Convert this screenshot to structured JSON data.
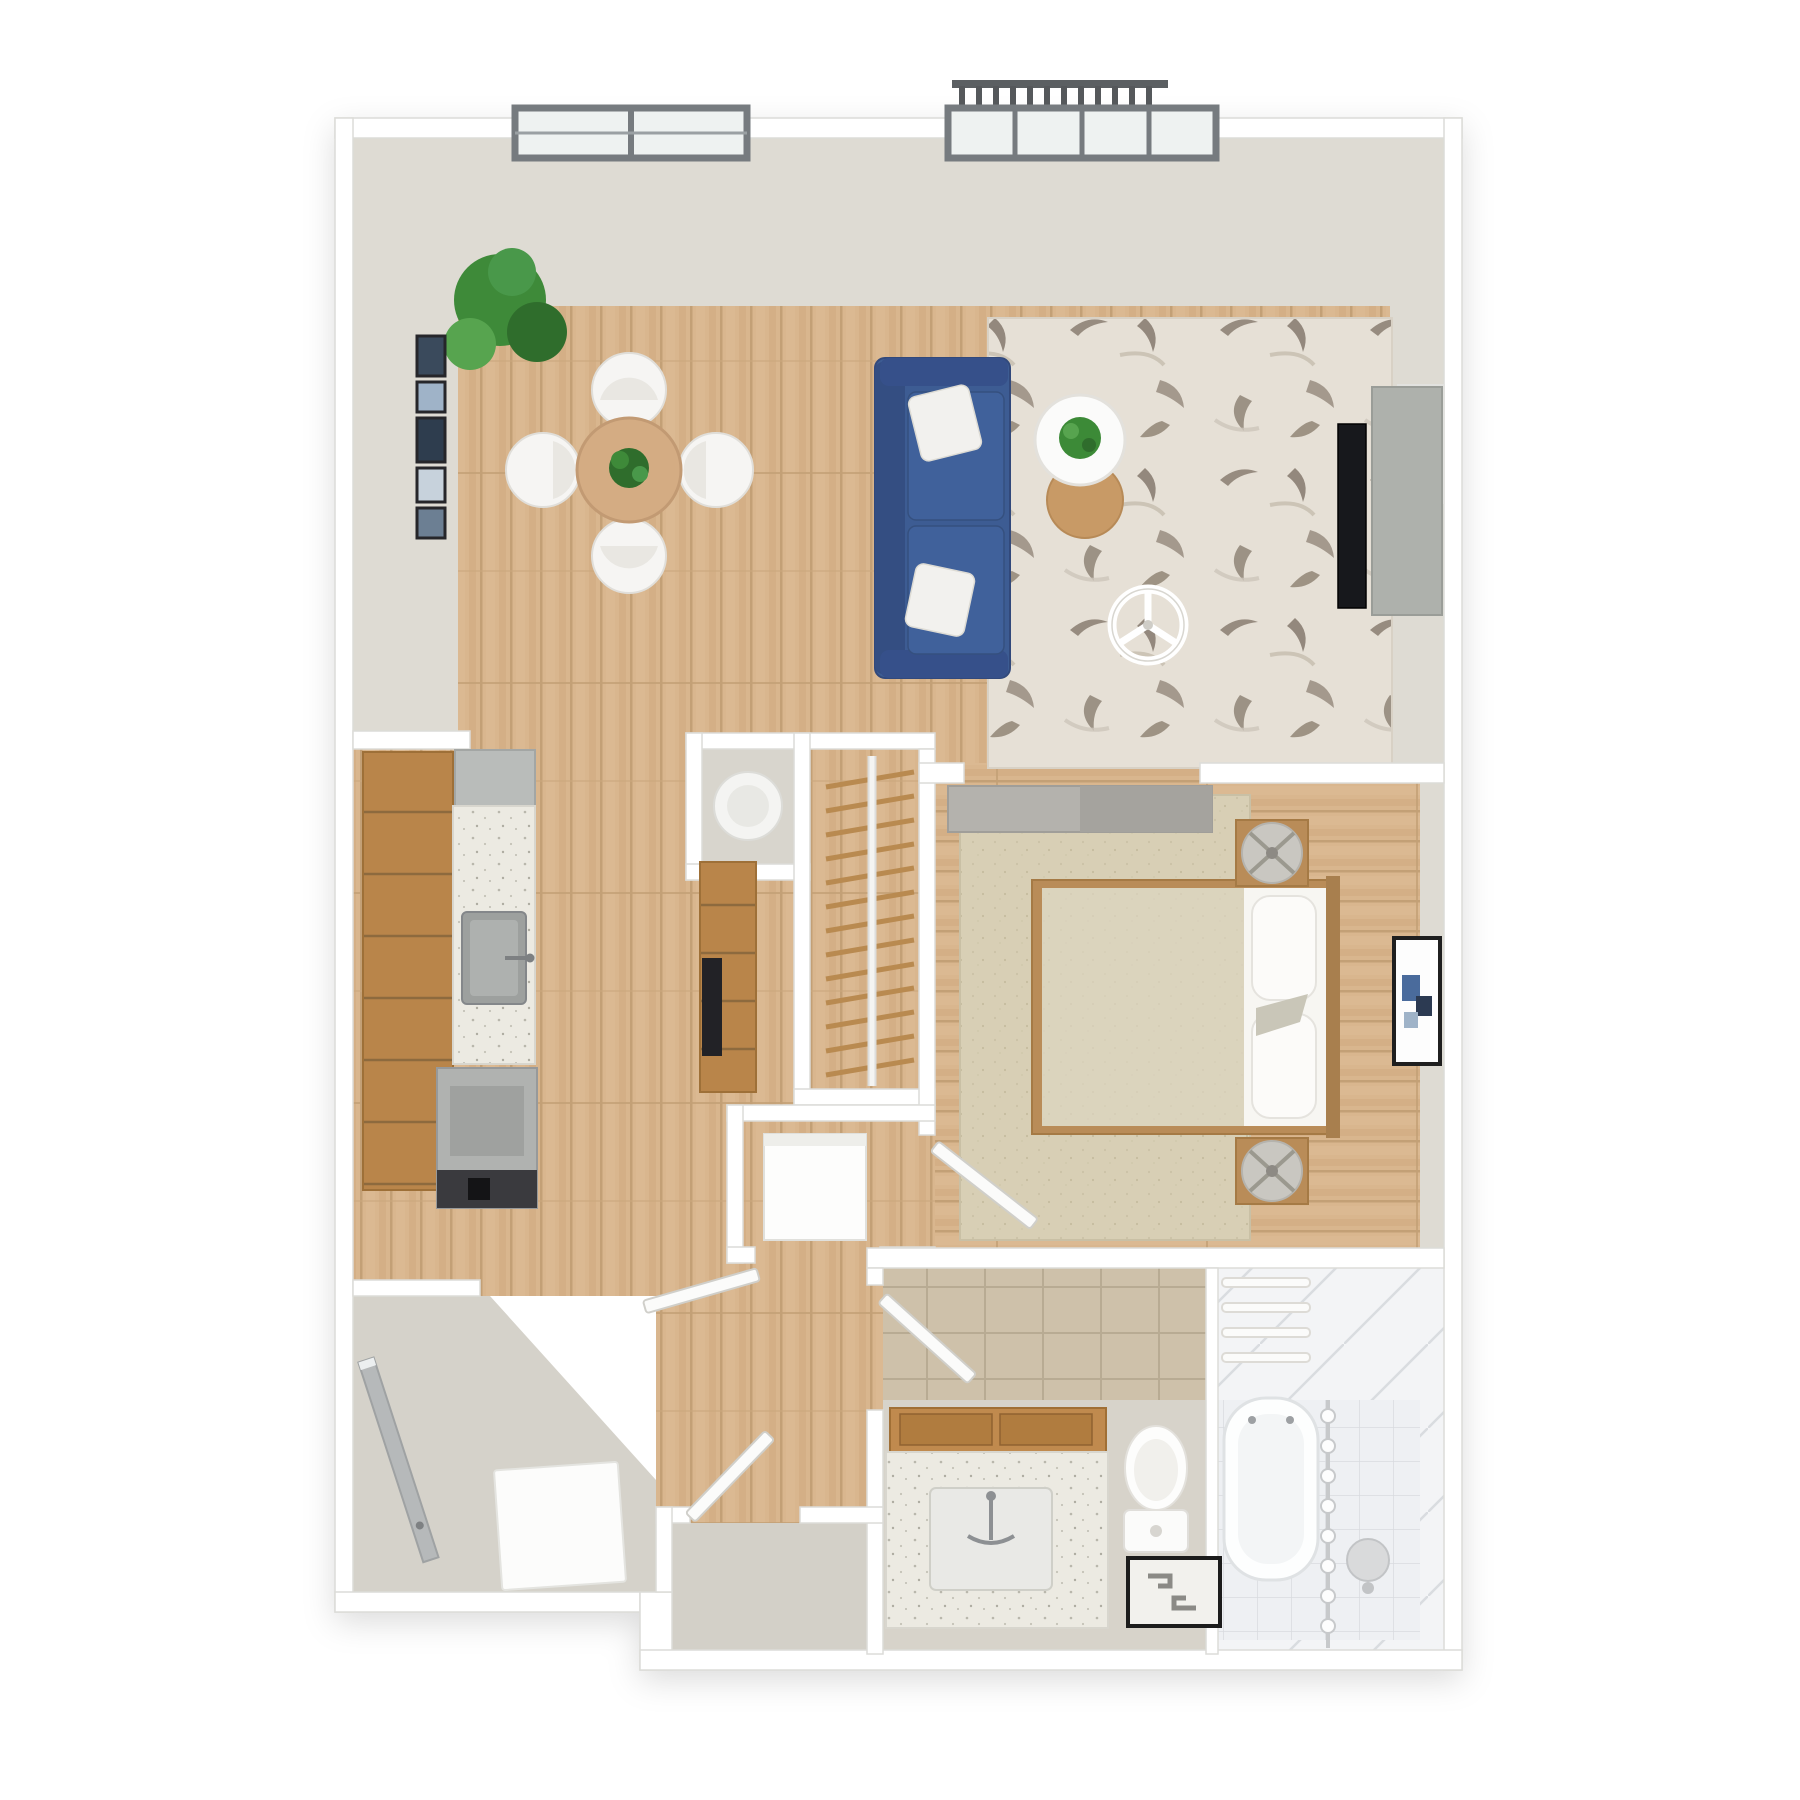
{
  "meta": {
    "artwork": "3D top-down floor plan rendering",
    "unit_type": "one-bedroom apartment",
    "visible_text": "none"
  },
  "palette": {
    "background": "#ffffff",
    "wall_white": "#ffffff",
    "wall_edge": "#dcdcd8",
    "wall_face_greige": "#dedbd3",
    "wood_floor": "#d9b68e",
    "wood_plank_dark": "#c3a076",
    "entry_floor_gray": "#d5d2ca",
    "rug_living_base": "#e6e0d6",
    "rug_living_motif": "#8a7e71",
    "rug_bedroom": "#d8cfb5",
    "sofa_blue": "#3d5c93",
    "cabinet_wood": "#b9854a",
    "counter_speckle": "#eceae2",
    "appliance_gray": "#b0b2b0",
    "oven_black": "#313136",
    "tv_black": "#17181c",
    "console_gray": "#aeb1ac",
    "tile_tan": "#cec1aa",
    "tile_white": "#f3f4f6",
    "window_frame": "#767b7f",
    "window_glass": "#eef2f1",
    "plant_green": "#3e8a39",
    "lamp_gray": "#c9c7c1",
    "front_door_gray": "#b6b9ba"
  },
  "rooms": {
    "living": {
      "label": "Living room",
      "furniture": [
        "blue sofa with two white pillows",
        "patterned area rug",
        "round white coffee table with plant",
        "round wood side table",
        "wall-mounted TV",
        "media console",
        "decorative fan ornament"
      ]
    },
    "dining": {
      "label": "Dining area",
      "furniture": [
        "round dining table",
        "four white tub chairs",
        "table centerpiece plant",
        "potted floor plant",
        "gallery wall frames"
      ]
    },
    "kitchen": {
      "label": "Kitchen",
      "furniture": [
        "wood cabinet run",
        "speckled countertop",
        "sink with faucet",
        "refrigerator",
        "range with oven"
      ]
    },
    "bedroom": {
      "label": "Bedroom",
      "furniture": [
        "double bed with beige duvet",
        "two pillows",
        "accent pillow",
        "two wood nightstands",
        "two round table lamps",
        "area rug",
        "framed wall art",
        "sliding barn door"
      ]
    },
    "bathroom": {
      "label": "Bathroom",
      "furniture": [
        "vanity with basket shelf",
        "inset sink with faucet",
        "toilet",
        "patterned floor mat",
        "bathtub with shower curtain rod",
        "towel bars",
        "shower stool"
      ]
    },
    "entry": {
      "label": "Entry",
      "furniture": [
        "front door",
        "door mat"
      ]
    },
    "hallway": {
      "label": "Hallway",
      "furniture": [
        "open interior doors"
      ]
    },
    "closet": {
      "label": "Walk-in closet",
      "furniture": [
        "clothes rod",
        "wood hangers",
        "tall wood pantry cabinet",
        "built-in oven column",
        "washer niche with round appliance"
      ]
    },
    "storage": {
      "label": "Storage alcove",
      "furniture": [
        "white utility cabinet"
      ]
    },
    "balcony": {
      "label": "Balcony",
      "furniture": [
        "sliding glass door",
        "railing with slats"
      ]
    }
  },
  "windows": {
    "dining_window_panes": 2,
    "balcony_door_panes": 4
  },
  "generated": {
    "closet_hangers": {
      "count": 13,
      "x1": 826,
      "x2": 914,
      "y_start": 772,
      "step": 24,
      "rise": 15
    },
    "railing_slats": {
      "count": 12,
      "x_start": 962,
      "step": 17,
      "y1": 86,
      "y2": 110
    },
    "curtain_rings": {
      "count": 8,
      "x": 1328,
      "y_start": 1416,
      "step": 30,
      "r": 7
    },
    "towel_bars": {
      "count": 4,
      "x": 1222,
      "w": 88,
      "h": 9,
      "y_start": 1278,
      "step": 25
    },
    "wall_frames": {
      "x": 417,
      "w": 28,
      "items": [
        {
          "y": 336,
          "h": 40,
          "color": "#3a4a5c"
        },
        {
          "y": 382,
          "h": 30,
          "color": "#9fb3c8"
        },
        {
          "y": 418,
          "h": 44,
          "color": "#2e3d4e"
        },
        {
          "y": 468,
          "h": 34,
          "color": "#c7d2dc"
        },
        {
          "y": 508,
          "h": 30,
          "color": "#6c7f93"
        }
      ]
    },
    "cabinet_seams": {
      "count": 7,
      "x1": 364,
      "x2": 452,
      "y_start": 812,
      "step": 62
    },
    "pantry_seams": {
      "count": 4,
      "x1": 701,
      "x2": 755,
      "y_start": 905,
      "step": 48
    }
  }
}
